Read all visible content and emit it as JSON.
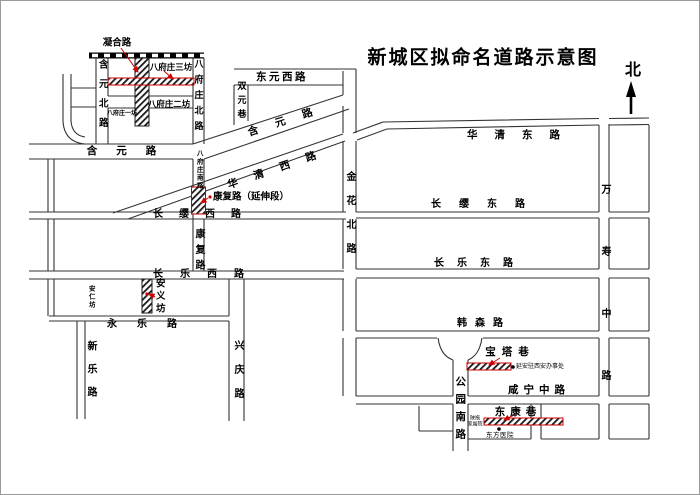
{
  "title": "新城区拟命名道路示意图",
  "compass": {
    "north_label": "北"
  },
  "colors": {
    "accent_red": "#cc0000",
    "line_black": "#333333",
    "proposed_hatch": "#1a1a1a"
  },
  "roads": {
    "ninghelu": "凝合路",
    "bafuzhuang_sanfang": "八府庄三坊",
    "bafuzhuang_erfang": "八府庄二坊",
    "bafuzhuang_yifang": "八府庄一坊",
    "hanyuan_north": "含元北路",
    "bafuzhuang_north": "八府庄北路",
    "shuangyuan_lane": "双元巷",
    "dongyuan_west": "东元西路",
    "hanyuan_west": "含元路",
    "hanyuan_diagonal": "含元路",
    "huaqing_west": "华清西路",
    "huaqing_east": "华清东路",
    "jinhua_north": "金花北路",
    "bafuzhuang_south": "八府庄南路",
    "kangfu_extension": "康复路（延伸段）",
    "changying_west": "长缨西路",
    "changying_east": "长缨东路",
    "kangfu": "康复路",
    "changle_west": "长乐西路",
    "changle_east": "长乐东路",
    "anren_fang": "安仁坊",
    "anyi_fang": "安义坊",
    "yongle": "永乐路",
    "xinle": "新乐路",
    "xingqing": "兴庆路",
    "hansen": "韩森路",
    "wanshou_middle": "万寿中路",
    "gongyuan_south": "公园南路",
    "xianning_middle": "咸宁中路",
    "baota_lane": "宝塔巷",
    "dongkang_lane": "东康巷"
  },
  "landmarks": {
    "yanan_office": "延安驻西安办事处",
    "dongfang_hospital": "东方医院",
    "shantuo_line1": "陕拖",
    "shantuo_line2": "家属院"
  }
}
